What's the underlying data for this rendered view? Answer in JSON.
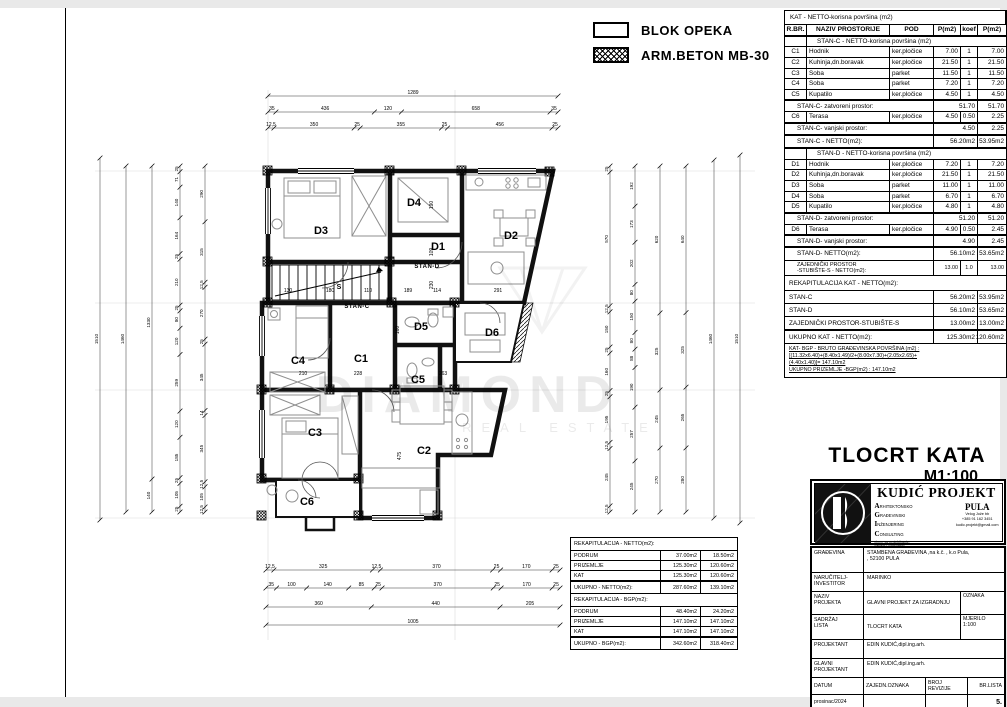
{
  "legend": {
    "items": [
      {
        "label": "BLOK OPEKA",
        "swatch": "blok-opeka"
      },
      {
        "label": "ARM.BETON   MB-30",
        "swatch": "arm-beton"
      }
    ]
  },
  "area_table": {
    "title": "KAT - NETTO-korisna površina (m2)",
    "columns": [
      "R.BR.",
      "NAZIV PROSTORIJE",
      "POD",
      "P(m2)",
      "koef",
      "P(m2)"
    ],
    "rows": [
      {
        "t": "section",
        "label": "STAN-C - NETTO-korisna površina (m2)"
      },
      {
        "t": "item",
        "id": "C1",
        "name": "Hodnik",
        "pod": "ker.pločice",
        "p1": "7.00",
        "k": "1",
        "p2": "7.00"
      },
      {
        "t": "item",
        "id": "C2",
        "name": "Kuhinja,dn.boravak",
        "pod": "ker.pločice",
        "p1": "21.50",
        "k": "1",
        "p2": "21.50"
      },
      {
        "t": "item",
        "id": "C3",
        "name": "Soba",
        "pod": "parket",
        "p1": "11.50",
        "k": "1",
        "p2": "11.50"
      },
      {
        "t": "item",
        "id": "C4",
        "name": "Soba",
        "pod": "parket",
        "p1": "7.20",
        "k": "1",
        "p2": "7.20"
      },
      {
        "t": "item",
        "id": "C5",
        "name": "Kupatilo",
        "pod": "ker.pločice",
        "p1": "4.50",
        "k": "1",
        "p2": "4.50"
      },
      {
        "t": "sub",
        "label": "STAN-C- zatvoreni prostor:",
        "p1": "51.70",
        "p2": "51.70"
      },
      {
        "t": "item",
        "id": "C6",
        "name": "Terasa",
        "pod": "ker.pločice",
        "p1": "4.50",
        "k": "0.50",
        "p2": "2.25"
      },
      {
        "t": "sub",
        "label": "STAN-C- vanjski prostor:",
        "p1": "4.50",
        "p2": "2.25"
      },
      {
        "t": "total",
        "label": "STAN-C - NETTO(m2):",
        "p1": "56.20m2",
        "p2": "53.95m2"
      },
      {
        "t": "section",
        "label": "STAN-D - NETTO-korisna površina (m2)"
      },
      {
        "t": "item",
        "id": "D1",
        "name": "Hodnik",
        "pod": "ker.pločice",
        "p1": "7.20",
        "k": "1",
        "p2": "7.20"
      },
      {
        "t": "item",
        "id": "D2",
        "name": "Kuhinja,dn.boravak",
        "pod": "ker.pločice",
        "p1": "21.50",
        "k": "1",
        "p2": "21.50"
      },
      {
        "t": "item",
        "id": "D3",
        "name": "Soba",
        "pod": "parket",
        "p1": "11.00",
        "k": "1",
        "p2": "11.00"
      },
      {
        "t": "item",
        "id": "D4",
        "name": "Soba",
        "pod": "parket",
        "p1": "6.70",
        "k": "1",
        "p2": "6.70"
      },
      {
        "t": "item",
        "id": "D5",
        "name": "Kupatilo",
        "pod": "ker.pločice",
        "p1": "4.80",
        "k": "1",
        "p2": "4.80"
      },
      {
        "t": "sub",
        "label": "STAN-D- zatvoreni prostor:",
        "p1": "51.20",
        "p2": "51.20"
      },
      {
        "t": "item",
        "id": "D6",
        "name": "Terasa",
        "pod": "ker.pločice",
        "p1": "4.90",
        "k": "0.50",
        "p2": "2.45"
      },
      {
        "t": "sub",
        "label": "STAN-D- vanjski prostor:",
        "p1": "4.90",
        "p2": "2.45"
      },
      {
        "t": "total",
        "label": "STAN-D- NETTO(m2):",
        "p1": "56.10m2",
        "p2": "53.65m2"
      },
      {
        "t": "zaj",
        "label": "ZAJEDNIČKI PROSTOR\n-STUBIŠTE-S - NETTO(m2):",
        "p1": "13.00",
        "k": "1.0",
        "p2": "13.00"
      },
      {
        "t": "rhead",
        "label": "REKAPITULACIJA KAT - NETTO(m2):"
      },
      {
        "t": "recap",
        "label": "STAN-C",
        "p1": "56.20m2",
        "p2": "53.95m2"
      },
      {
        "t": "recap",
        "label": "STAN-D",
        "p1": "56.10m2",
        "p2": "53.65m2"
      },
      {
        "t": "recap",
        "label": "ZAJEDNIČKI PROSTOR-STUBIŠTE-S",
        "p1": "13.00m2",
        "p2": "13.00m2"
      },
      {
        "t": "rtotal",
        "label": "UKUPNO KAT        - NETTO(m2):",
        "p1": "125.30m2",
        "p2": "120.60m2"
      },
      {
        "t": "note",
        "lines": [
          "KAT- BGP - BRUTO GRAĐEVINSKA POVRŠINA (m2) :",
          "[(11.32x6.40)+(8.40x1.49)/2+(8.00x7.30)+(2.05x2.65)+",
          "(4.40x1.40)]= 147.10m2",
          "UKUPNO PRIZEMLJE -BGP(m2) :        147.10m2"
        ]
      }
    ]
  },
  "recap_tables": [
    {
      "title": "REKAPITULACIJA - NETTO(m2):",
      "rows": [
        [
          "PODRUM",
          "37.00m2",
          "18.50m2"
        ],
        [
          "PRIZEMLJE",
          "125.30m2",
          "120.60m2"
        ],
        [
          "KAT",
          "125.30m2",
          "120.60m2"
        ]
      ],
      "total": [
        "UKUPNO - NETTO(m2):",
        "287.60m2",
        "139.10m2"
      ]
    },
    {
      "title": "REKAPITULACIJA - BGP(m2):",
      "rows": [
        [
          "PODRUM",
          "48.40m2",
          "24.20m2"
        ],
        [
          "PRIZEMLJE",
          "147.10m2",
          "147.10m2"
        ],
        [
          "KAT",
          "147.10m2",
          "147.10m2"
        ]
      ],
      "total": [
        "UKUPNO - BGP(m2):",
        "342.60m2",
        "318.40m2"
      ]
    }
  ],
  "drawing_title": {
    "line1": "TLOCRT KATA",
    "line2": "M1:100"
  },
  "firm": {
    "name": "KUDIĆ PROJEKT",
    "city": "PULA",
    "services": [
      {
        "i": "A",
        "rest": "RHITEKTONSKO"
      },
      {
        "i": "G",
        "rest": "RAĐEVINSKI"
      },
      {
        "i": "I",
        "rest": "NŽENJERING"
      },
      {
        "i": "C",
        "rest": "ONSULTING"
      }
    ],
    "sub": "d.o.o. za projektiranje,\nnadzor i consulting",
    "addr": "Velog Jože bb",
    "phone": "+385 91 162 3451",
    "email": "kudic.projekt@gmail.com"
  },
  "title_block": {
    "r1": {
      "label": "GRAĐEVINA",
      "v1": "STAMBENA  GRAĐEVINA  ,na k.č.        , k.o Pula,",
      "v2": ", 52100 PULA"
    },
    "r2": {
      "label": "NARUČITELJ-\nINVESTITOR",
      "v": "MARINKO"
    },
    "r3": {
      "label": "NAZIV\nPROJEKTA",
      "v": "GLAVNI PROJEKT ZA IZGRADNJU",
      "aux": "OZNAKA"
    },
    "r4": {
      "label": "SADRŽAJ\nLISTA",
      "v": "TLOCRT KATA",
      "aux": "MJERILO",
      "aux2": "1:100"
    },
    "r5": {
      "label": "PROJEKTANT",
      "v": "EDIN KUDIĆ,dipl.ing.arh."
    },
    "r6": {
      "label": "GLAVNI\nPROJEKTANT",
      "v": "EDIN KUDIĆ,dipl.ing.arh."
    },
    "footer": {
      "labels": [
        "DATUM",
        "ZAJEDN.OZNAKA",
        "BROJ REVIZIJE",
        "BR.LISTA"
      ],
      "values": [
        "prosinac/2024",
        "",
        "",
        "5."
      ]
    }
  },
  "plan": {
    "watermark": {
      "line1": "DIAMOND",
      "line2": "REAL ESTATE"
    },
    "rooms": [
      {
        "id": "D3",
        "x": 321,
        "y": 234
      },
      {
        "id": "D4",
        "x": 414,
        "y": 206
      },
      {
        "id": "D1",
        "x": 438,
        "y": 250
      },
      {
        "id": "D2",
        "x": 511,
        "y": 239
      },
      {
        "id": "D5",
        "x": 421,
        "y": 330
      },
      {
        "id": "D6",
        "x": 492,
        "y": 336
      },
      {
        "id": "C4",
        "x": 298,
        "y": 364
      },
      {
        "id": "C1",
        "x": 361,
        "y": 362
      },
      {
        "id": "C5",
        "x": 418,
        "y": 383
      },
      {
        "id": "C3",
        "x": 315,
        "y": 436
      },
      {
        "id": "C2",
        "x": 424,
        "y": 454
      },
      {
        "id": "C6",
        "x": 307,
        "y": 505
      }
    ],
    "stan_labels": [
      {
        "t": "STAN-D",
        "x": 427,
        "y": 268
      },
      {
        "t": "STAN-C",
        "x": 357,
        "y": 308
      }
    ],
    "annotations": [
      {
        "t": "130",
        "x": 288,
        "y": 292
      },
      {
        "t": "180",
        "x": 330,
        "y": 292
      },
      {
        "t": "110",
        "x": 368,
        "y": 292
      },
      {
        "t": "189",
        "x": 408,
        "y": 292
      },
      {
        "t": "114",
        "x": 437,
        "y": 292
      },
      {
        "t": "291",
        "x": 498,
        "y": 292
      },
      {
        "t": "210",
        "x": 303,
        "y": 375
      },
      {
        "t": "228",
        "x": 358,
        "y": 375
      },
      {
        "t": "263",
        "x": 443,
        "y": 375
      },
      {
        "t": "S",
        "x": 339,
        "y": 289,
        "b": 1
      },
      {
        "t": "190",
        "x": 433,
        "y": 205,
        "r": 1
      },
      {
        "t": "109",
        "x": 433,
        "y": 252,
        "r": 1
      },
      {
        "t": "230",
        "x": 433,
        "y": 285,
        "r": 1
      },
      {
        "t": "160",
        "x": 399,
        "y": 330,
        "r": 1
      },
      {
        "t": "475",
        "x": 401,
        "y": 456,
        "r": 1
      }
    ],
    "dim_chains": [
      {
        "o": "h",
        "x": 268,
        "y": 96,
        "len": 290,
        "vals": [
          "1289"
        ]
      },
      {
        "o": "h",
        "x": 268,
        "y": 112,
        "len": 290,
        "vals": [
          "35",
          "436",
          "120",
          "658",
          "35"
        ]
      },
      {
        "o": "h",
        "x": 268,
        "y": 128,
        "len": 290,
        "vals": [
          "12,5",
          "350",
          "25",
          "355",
          "25",
          "456",
          "25"
        ]
      },
      {
        "o": "h",
        "x": 266,
        "y": 570,
        "len": 294,
        "vals": [
          "12,5",
          "325",
          "12,5",
          "370",
          "25",
          "170",
          "25"
        ]
      },
      {
        "o": "h",
        "x": 266,
        "y": 588,
        "len": 294,
        "vals": [
          "35",
          "100",
          "140",
          "85",
          "25",
          "370",
          "25",
          "170",
          "25"
        ]
      },
      {
        "o": "h",
        "x": 266,
        "y": 607,
        "len": 294,
        "vals": [
          "360",
          "440",
          "205"
        ]
      },
      {
        "o": "h",
        "x": 266,
        "y": 625,
        "len": 294,
        "vals": [
          "1005"
        ]
      },
      {
        "o": "v",
        "x": 100,
        "y": 158,
        "len": 362,
        "vals": [
          "1510"
        ]
      },
      {
        "o": "v",
        "x": 126,
        "y": 166,
        "len": 346,
        "vals": [
          "1460"
        ]
      },
      {
        "o": "v",
        "x": 152,
        "y": 166,
        "len": 346,
        "vals": [
          "1330",
          "140"
        ]
      },
      {
        "o": "v",
        "x": 180,
        "y": 166,
        "len": 346,
        "vals": [
          "25",
          "71",
          "140",
          "164",
          "25",
          "210",
          "25",
          "80",
          "120",
          "259",
          "120",
          "185",
          "25",
          "105",
          "25"
        ]
      },
      {
        "o": "v",
        "x": 205,
        "y": 166,
        "len": 346,
        "vals": [
          "290",
          "315",
          "12,5",
          "270",
          "25",
          "345",
          "14",
          "345",
          "12,5",
          "105",
          "12,5"
        ]
      },
      {
        "o": "v",
        "x": 610,
        "y": 166,
        "len": 346,
        "vals": [
          "25",
          "570",
          "12,5",
          "150",
          "25",
          "160",
          "25",
          "195",
          "12,5",
          "245",
          "12,5"
        ]
      },
      {
        "o": "v",
        "x": 635,
        "y": 166,
        "len": 346,
        "vals": [
          "192",
          "173",
          "202",
          "80",
          "150",
          "80",
          "88",
          "190",
          "257",
          "245"
        ]
      },
      {
        "o": "v",
        "x": 660,
        "y": 166,
        "len": 346,
        "vals": [
          "620",
          "325",
          "245",
          "270"
        ]
      },
      {
        "o": "v",
        "x": 686,
        "y": 166,
        "len": 346,
        "vals": [
          "640",
          "325",
          "265",
          "280"
        ]
      },
      {
        "o": "v",
        "x": 714,
        "y": 160,
        "len": 358,
        "vals": [
          "1460"
        ]
      },
      {
        "o": "v",
        "x": 740,
        "y": 155,
        "len": 368,
        "vals": [
          "1510"
        ]
      }
    ]
  }
}
